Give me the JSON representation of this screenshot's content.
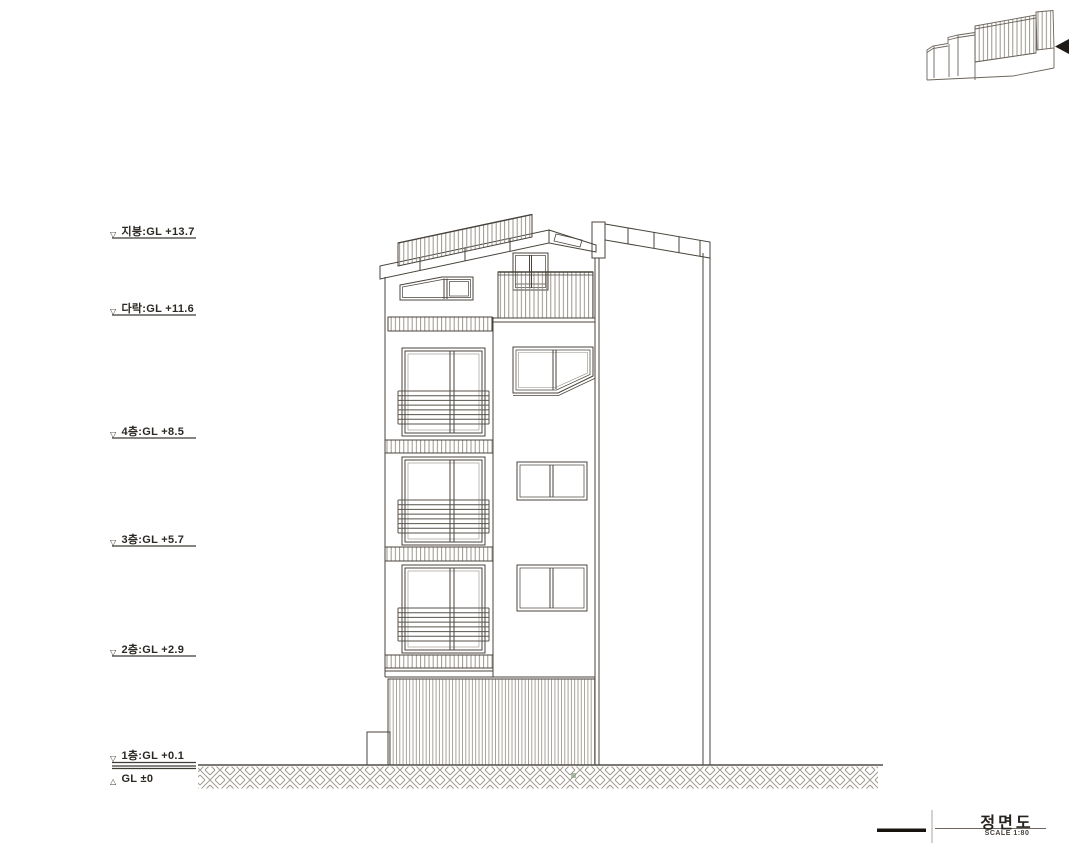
{
  "title_block": {
    "title": "정면도",
    "scale": "SCALE 1:80"
  },
  "levels": [
    {
      "symbol": "▽",
      "label": "지붕:GL +13.7"
    },
    {
      "symbol": "▽",
      "label": "다락:GL +11.6"
    },
    {
      "symbol": "▽",
      "label": "4층:GL +8.5"
    },
    {
      "symbol": "▽",
      "label": "3층:GL +5.7"
    },
    {
      "symbol": "▽",
      "label": "2층:GL +2.9"
    },
    {
      "symbol": "▽",
      "label": "1층:GL +0.1"
    },
    {
      "symbol": "△",
      "label": "GL ±0"
    }
  ]
}
